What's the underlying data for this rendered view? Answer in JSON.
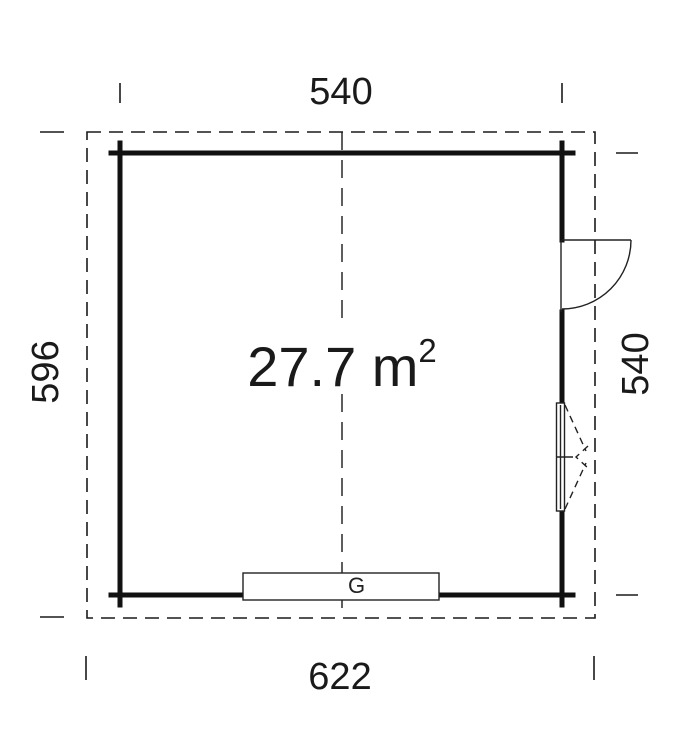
{
  "plan": {
    "area": {
      "value": "27.7 m",
      "superscript": "2"
    },
    "dimensions": {
      "top": "540",
      "bottom": "622",
      "left": "596",
      "right": "540"
    },
    "gate_label": "G"
  },
  "colors": {
    "line": "#1a1a1a",
    "wall": "#111111",
    "background": "#ffffff"
  }
}
